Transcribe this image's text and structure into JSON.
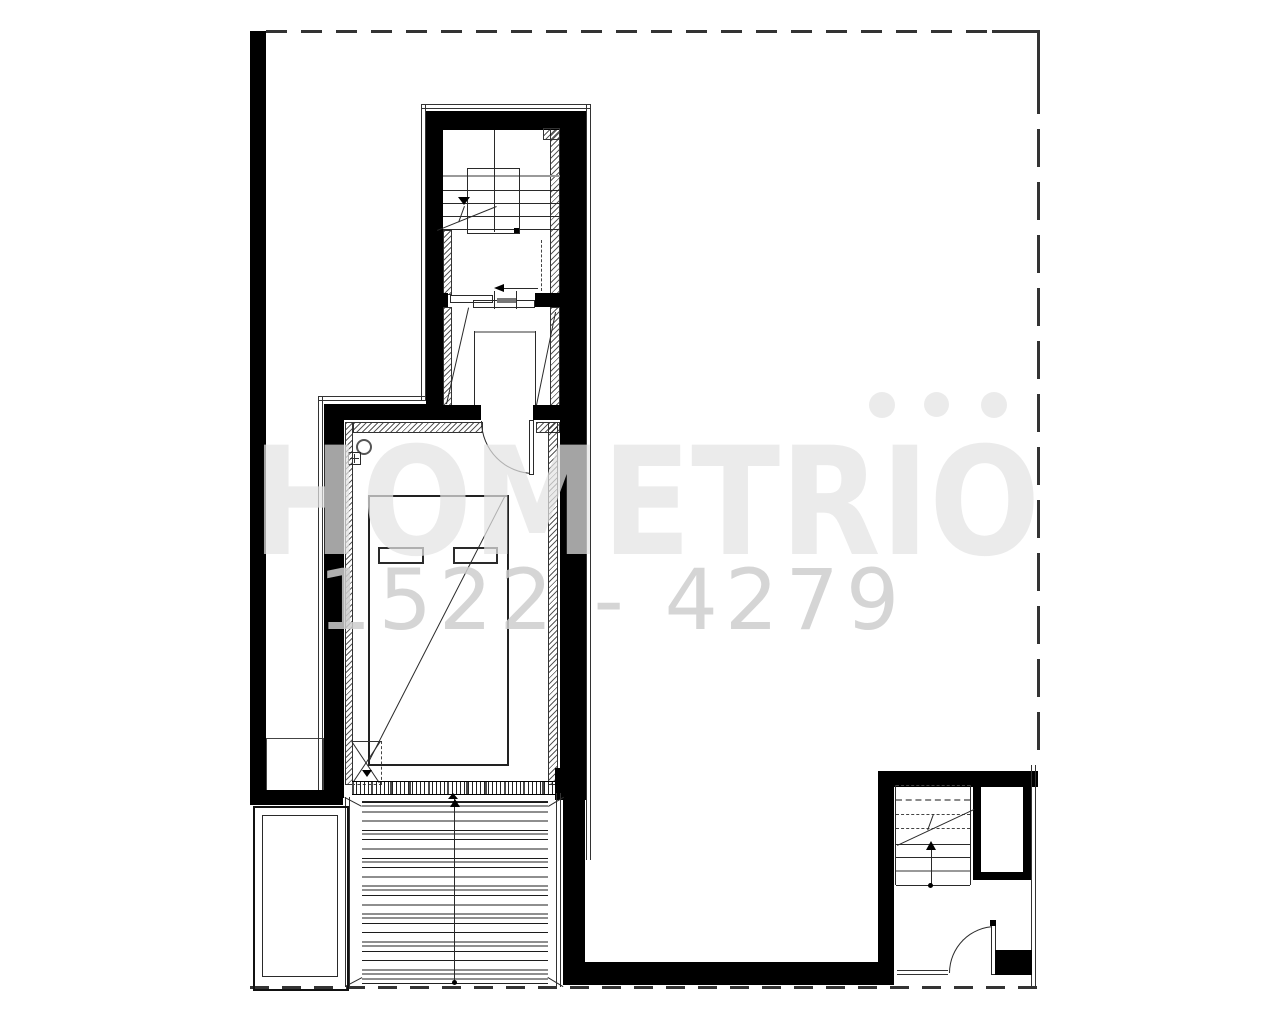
{
  "watermark": {
    "brand": "HOMETRIO",
    "number": "1522 - 4279"
  },
  "colors": {
    "background": "#ffffff",
    "wall": "#000000",
    "thin_line": "#2a2a2a",
    "gray_line": "#999999",
    "boundary_dash": "#333333",
    "watermark_letters": "rgba(227,227,227,0.72)",
    "watermark_number": "rgba(206,206,206,0.85)"
  },
  "plan": {
    "type": "floor-plan",
    "elements": [
      "dashed-property-boundary",
      "left-boundary-wall",
      "upper-stair-hall",
      "sliding-door",
      "vestibule",
      "bedroom-with-bed",
      "service-shaft",
      "glazed-window-band",
      "wood-deck",
      "planter",
      "entry-stair-room",
      "closet",
      "entry-door"
    ]
  }
}
